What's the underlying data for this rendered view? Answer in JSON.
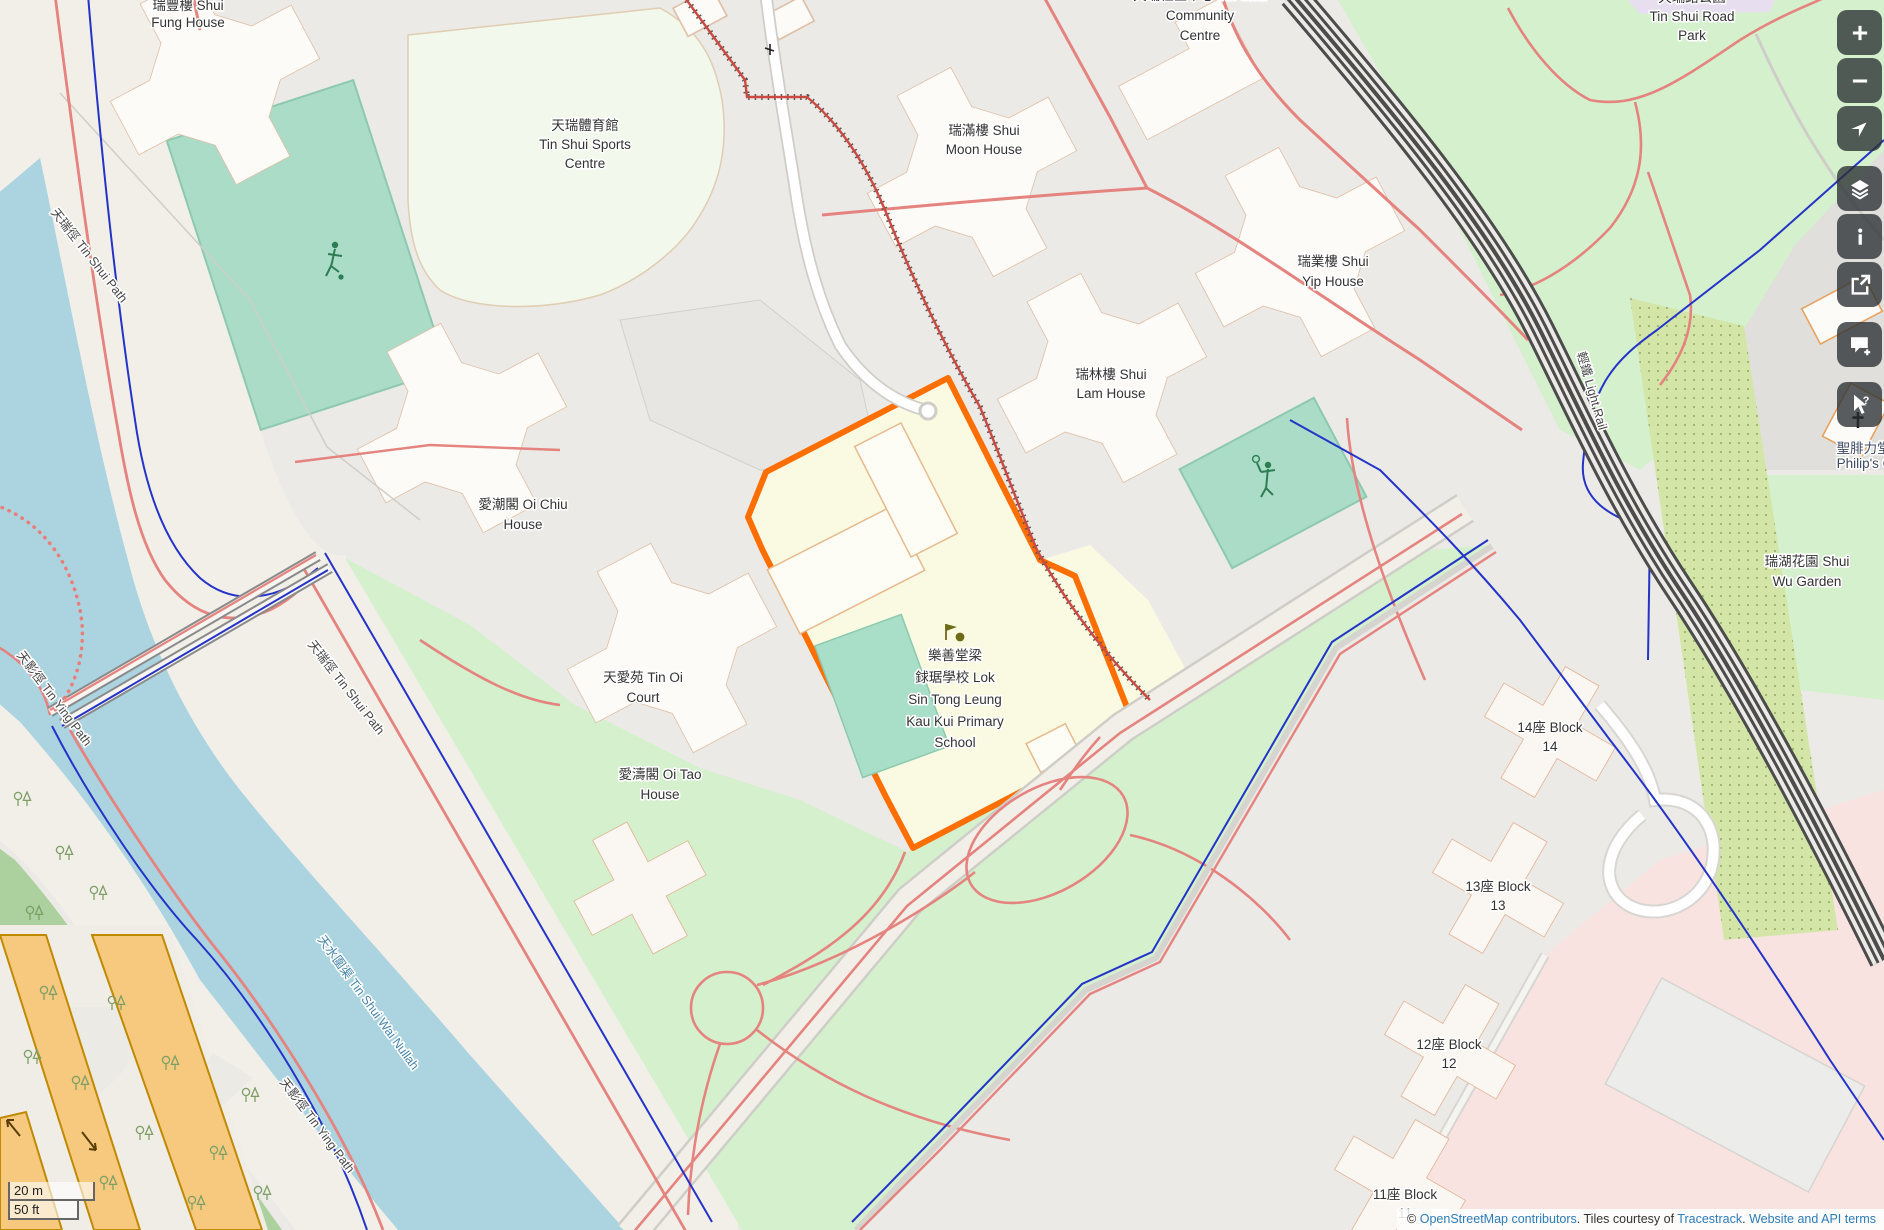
{
  "map": {
    "labels": {
      "shui_fung": {
        "l1": "瑞豐樓 Shui",
        "l2": "Fung House"
      },
      "sports_centre": {
        "l1": "天瑞體育館",
        "l2": "Tin Shui Sports",
        "l3": "Centre"
      },
      "moon_house": {
        "l1": "瑞滿樓 Shui",
        "l2": "Moon House"
      },
      "community_centre": {
        "l0": "天瑞社區中心 Tin Shui",
        "l1": "Community",
        "l2": "Centre"
      },
      "yip_house": {
        "l1": "瑞業樓 Shui",
        "l2": "Yip House"
      },
      "lam_house": {
        "l1": "瑞林樓 Shui",
        "l2": "Lam House"
      },
      "oi_chiu": {
        "l1": "愛潮閣 Oi Chiu",
        "l2": "House"
      },
      "tin_oi": {
        "l1": "天愛苑 Tin Oi",
        "l2": "Court"
      },
      "oi_tao": {
        "l1": "愛濤閣 Oi Tao",
        "l2": "House"
      },
      "school": {
        "l1": "樂善堂梁",
        "l2": "銶琚學校 Lok",
        "l3": "Sin Tong Leung",
        "l4": "Kau Kui Primary",
        "l5": "School"
      },
      "road_park": {
        "l1": "天瑞路公園",
        "l2": "Tin Shui Road",
        "l3": "Park"
      },
      "shui_wu_garden": {
        "l1": "瑞湖花園 Shui",
        "l2": "Wu Garden"
      },
      "church": {
        "l1": "聖腓力堂 S",
        "l2": "Philip's Chu"
      },
      "block14": {
        "l1": "14座 Block",
        "l2": "14"
      },
      "block13": {
        "l1": "13座 Block",
        "l2": "13"
      },
      "block12": {
        "l1": "12座 Block",
        "l2": "12"
      },
      "block11": {
        "l1": "11座 Block",
        "l2": "11"
      }
    },
    "path_labels": {
      "tin_shui_path_1": "天瑞徑 Tin Shui Path",
      "tin_shui_path_2": "天瑞徑 Tin Shui Path",
      "tin_ying_path_1": "天影徑 Tin Ying Path",
      "tin_ying_path_2": "天影徑 Tin Ying Path",
      "nullah": "天水圍渠 Tin Shui Wai Nullah",
      "light_rail": "輕鐵 Light Rail"
    },
    "icons": [
      "school-icon",
      "soccer-player-icon",
      "tennis-player-icon",
      "church-cross-icon",
      "tree-icons",
      "gate-icon",
      "oneway-arrow-icons"
    ],
    "colors": {
      "highlight_orange": "#ff6e00",
      "water": "#abd4e0",
      "park_green": "#d5f0cd",
      "wood_green": "#add19e",
      "pitch_teal": "#aadcc8",
      "school_yellow": "#fafae2",
      "bank_cream": "#f2efe9",
      "salmon_path": "#e5837f",
      "boundary_blue": "#2433c8",
      "road_orange": "#f6c97e"
    }
  },
  "controls": {
    "zoom_in": {
      "label": "+",
      "name": "zoom-in"
    },
    "zoom_out": {
      "label": "−",
      "name": "zoom-out"
    },
    "locate": {
      "name": "show-my-location"
    },
    "layers": {
      "name": "layers"
    },
    "info": {
      "label": "i",
      "name": "map-key"
    },
    "share": {
      "name": "share"
    },
    "note": {
      "name": "add-note"
    },
    "query": {
      "label": "?",
      "name": "query-features"
    }
  },
  "scale": {
    "metric": "20 m",
    "imperial": "50 ft"
  },
  "attribution": {
    "copyright": "©",
    "osm_link": "OpenStreetMap contributors",
    "tiles_text": ". Tiles courtesy of ",
    "tracestrack_link": "Tracestrack",
    "separator": ". ",
    "terms_link": "Website and API terms"
  }
}
